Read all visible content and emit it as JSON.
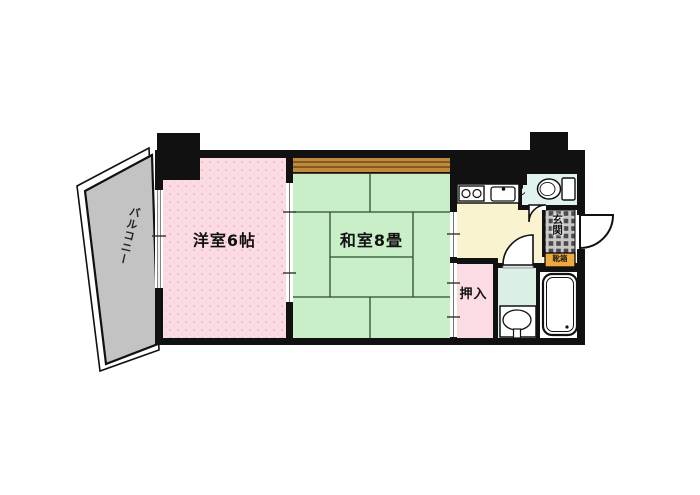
{
  "rooms": {
    "balcony": {
      "label": "バルコニー"
    },
    "western": {
      "label": "洋室6帖"
    },
    "japanese": {
      "label": "和室8畳"
    },
    "closet": {
      "label": "押入"
    },
    "toilet": {
      "label": "トイレ"
    },
    "entrance": {
      "label": "玄関"
    },
    "shoe_box": {
      "label": "靴箱"
    }
  },
  "colors": {
    "wall": "#111111",
    "western_room": "#fbdce2",
    "western_room_dots": "#eab5c0",
    "japanese_room": "#c9efc9",
    "tatami_line": "#2b4d2b",
    "wood_strip": "#bf8a3d",
    "kitchen": "#f9f3cf",
    "toilet_room": "#e0f3f1",
    "washroom": "#dbf0e5",
    "closet": "#fbdce2",
    "entrance_tile": "#c9c9c9",
    "entrance_tile_dark": "#4a4a4a",
    "shoe_box": "#f2a93b",
    "balcony": "#c3c3c3"
  }
}
